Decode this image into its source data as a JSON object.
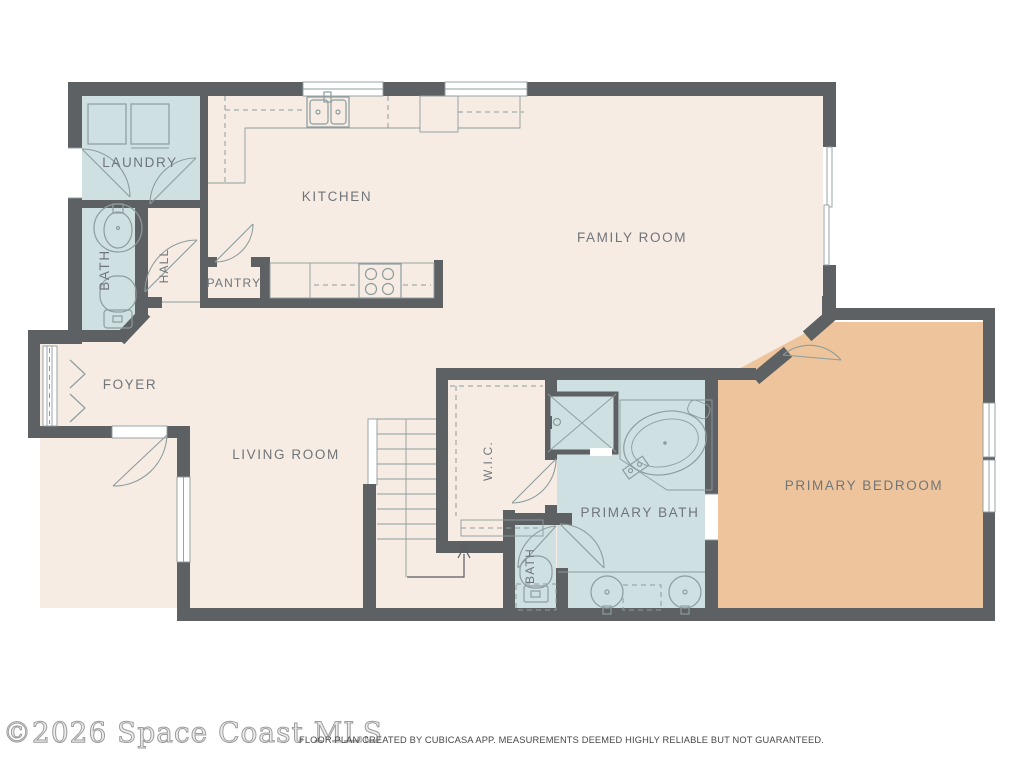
{
  "document_type": "residential floor plan",
  "rooms": {
    "laundry": {
      "label": "LAUNDRY"
    },
    "kitchen": {
      "label": "KITCHEN"
    },
    "family_room": {
      "label": "FAMILY ROOM"
    },
    "bath": {
      "label": "BATH"
    },
    "hall": {
      "label": "HALL"
    },
    "pantry": {
      "label": "PANTRY"
    },
    "foyer": {
      "label": "FOYER"
    },
    "living_room": {
      "label": "LIVING ROOM"
    },
    "wic": {
      "label": "W.I.C."
    },
    "primary_bath": {
      "label": "PRIMARY BATH"
    },
    "bath2": {
      "label": "BATH"
    },
    "primary_bedroom": {
      "label": "PRIMARY BEDROOM"
    }
  },
  "footer": {
    "watermark": "©2026 Space Coast MLS",
    "disclaimer": "FLOOR PLAN CREATED BY CUBICASA APP. MEASUREMENTS DEEMED HIGHLY RELIABLE BUT NOT GUARANTEED."
  },
  "colors": {
    "wall": "#5e6163",
    "floor": "#f6ece3",
    "wet": "#cee0e2",
    "bedroom": "#eec49c",
    "fixture": "#8e9c9e",
    "label": "#70757a",
    "bg": "#ffffff",
    "disclaimer": "#474747"
  }
}
